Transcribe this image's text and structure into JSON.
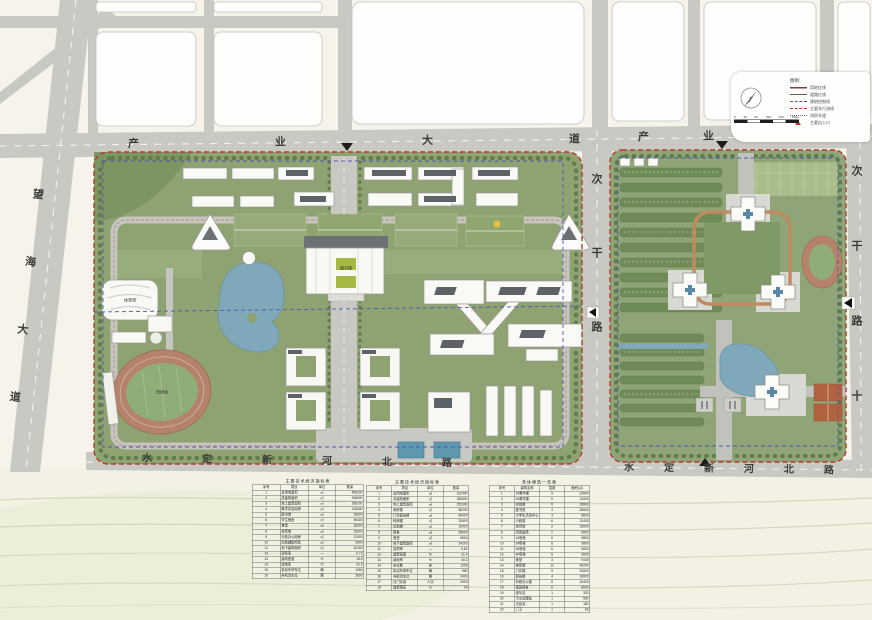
{
  "colors": {
    "boundary_red": "#b03a2e",
    "setback_blue": "#4a58b0",
    "road_gray": "#c9c9c4",
    "campus_green": "#8ea272",
    "water_blue": "#7fa8ba",
    "track_brick": "#b5826b",
    "loop_tan": "#bf8a5e"
  },
  "roads": {
    "industry_avenue": "产业大道",
    "wanghai_avenue": "望海大道",
    "secondary_road_mid": "次干路",
    "secondary_road_right": "次干路十",
    "shuiding_xinhe_north_road": "水定新河北路"
  },
  "legend": {
    "title": "图例:",
    "items": [
      {
        "label": "用地红线"
      },
      {
        "label": "道路红线"
      },
      {
        "label": "建筑控制线"
      },
      {
        "label": "主要车行流线"
      },
      {
        "label": "消防车道"
      },
      {
        "label": "主要出入口"
      }
    ]
  },
  "scalebar": {
    "labels": [
      "0",
      "25",
      "50",
      "100",
      "150",
      "200m"
    ]
  },
  "map_labels": {
    "library": "图书馆",
    "gymnasium": "体育馆",
    "stadium": "田径场"
  },
  "tables": [
    {
      "title": "主要技术经济指标表",
      "headers": [
        "序号",
        "项目",
        "单位",
        "数量"
      ],
      "rows": [
        [
          "1",
          "总用地面积",
          "㎡",
          "486200"
        ],
        [
          "2",
          "总建筑面积",
          "㎡",
          "398600"
        ],
        [
          "3",
          "地上建筑面积",
          "㎡",
          "356200"
        ],
        [
          "4",
          "教学实验用房",
          "㎡",
          "126500"
        ],
        [
          "5",
          "图书馆",
          "㎡",
          "28600"
        ],
        [
          "6",
          "学生宿舍",
          "㎡",
          "95400"
        ],
        [
          "7",
          "食堂",
          "㎡",
          "18200"
        ],
        [
          "8",
          "体育馆",
          "㎡",
          "15600"
        ],
        [
          "9",
          "行政办公用房",
          "㎡",
          "12400"
        ],
        [
          "10",
          "后勤辅助用房",
          "㎡",
          "9800"
        ],
        [
          "11",
          "地下建筑面积",
          "㎡",
          "42400"
        ],
        [
          "12",
          "容积率",
          "—",
          "0.73"
        ],
        [
          "13",
          "建筑密度",
          "%",
          "18.6"
        ],
        [
          "14",
          "绿地率",
          "%",
          "42.5"
        ],
        [
          "15",
          "机动车停车位",
          "辆",
          "1260"
        ],
        [
          "16",
          "非机动车位",
          "辆",
          "3800"
        ]
      ]
    },
    {
      "title": "主要技术经济指标表",
      "headers": [
        "序号",
        "项目",
        "单位",
        "数量"
      ],
      "rows": [
        [
          "1",
          "总用地面积",
          "㎡",
          "312400"
        ],
        [
          "2",
          "总建筑面积",
          "㎡",
          "286500"
        ],
        [
          "3",
          "地上建筑面积",
          "㎡",
          "252300"
        ],
        [
          "4",
          "病房楼",
          "㎡",
          "86200"
        ],
        [
          "5",
          "门诊医技楼",
          "㎡",
          "65400"
        ],
        [
          "6",
          "科研楼",
          "㎡",
          "32600"
        ],
        [
          "7",
          "后勤楼",
          "㎡",
          "18400"
        ],
        [
          "8",
          "宿舍",
          "㎡",
          "28600"
        ],
        [
          "9",
          "食堂",
          "㎡",
          "9600"
        ],
        [
          "10",
          "地下建筑面积",
          "㎡",
          "34200"
        ],
        [
          "11",
          "容积率",
          "—",
          "0.82"
        ],
        [
          "12",
          "建筑密度",
          "%",
          "21.4"
        ],
        [
          "13",
          "绿地率",
          "%",
          "40.2"
        ],
        [
          "14",
          "床位数",
          "床",
          "1200"
        ],
        [
          "15",
          "机动车停车位",
          "辆",
          "980"
        ],
        [
          "16",
          "非机动车位",
          "辆",
          "2400"
        ],
        [
          "17",
          "日门诊量",
          "人次",
          "3000"
        ],
        [
          "18",
          "建筑限高",
          "m",
          "24"
        ]
      ]
    },
    {
      "title": "单体建筑一览表",
      "headers": [
        "序号",
        "建筑名称",
        "层数",
        "面积(㎡)"
      ],
      "rows": [
        [
          "1",
          "1#教学楼",
          "5",
          "12600"
        ],
        [
          "2",
          "2#教学楼",
          "5",
          "12600"
        ],
        [
          "3",
          "实验楼",
          "6",
          "15800"
        ],
        [
          "4",
          "图书馆",
          "4",
          "28600"
        ],
        [
          "5",
          "大学生活动中心",
          "3",
          "8600"
        ],
        [
          "6",
          "行政楼",
          "6",
          "12400"
        ],
        [
          "7",
          "体育馆",
          "2",
          "15600"
        ],
        [
          "8",
          "风雨操场",
          "2",
          "6800"
        ],
        [
          "9",
          "1#宿舍",
          "6",
          "9800"
        ],
        [
          "10",
          "2#宿舍",
          "6",
          "9800"
        ],
        [
          "11",
          "3#宿舍",
          "6",
          "9800"
        ],
        [
          "12",
          "4#宿舍",
          "6",
          "9800"
        ],
        [
          "13",
          "食堂",
          "3",
          "9100"
        ],
        [
          "14",
          "病房楼",
          "12",
          "46200"
        ],
        [
          "15",
          "门诊楼",
          "5",
          "32600"
        ],
        [
          "16",
          "医技楼",
          "4",
          "18600"
        ],
        [
          "17",
          "科研办公楼",
          "8",
          "16400"
        ],
        [
          "18",
          "值班宿舍",
          "6",
          "8600"
        ],
        [
          "19",
          "液氧站",
          "1",
          "320"
        ],
        [
          "20",
          "污水处理站",
          "1",
          "560"
        ],
        [
          "21",
          "垃圾站",
          "1",
          "180"
        ],
        [
          "22",
          "门卫",
          "1",
          "60"
        ]
      ]
    }
  ]
}
